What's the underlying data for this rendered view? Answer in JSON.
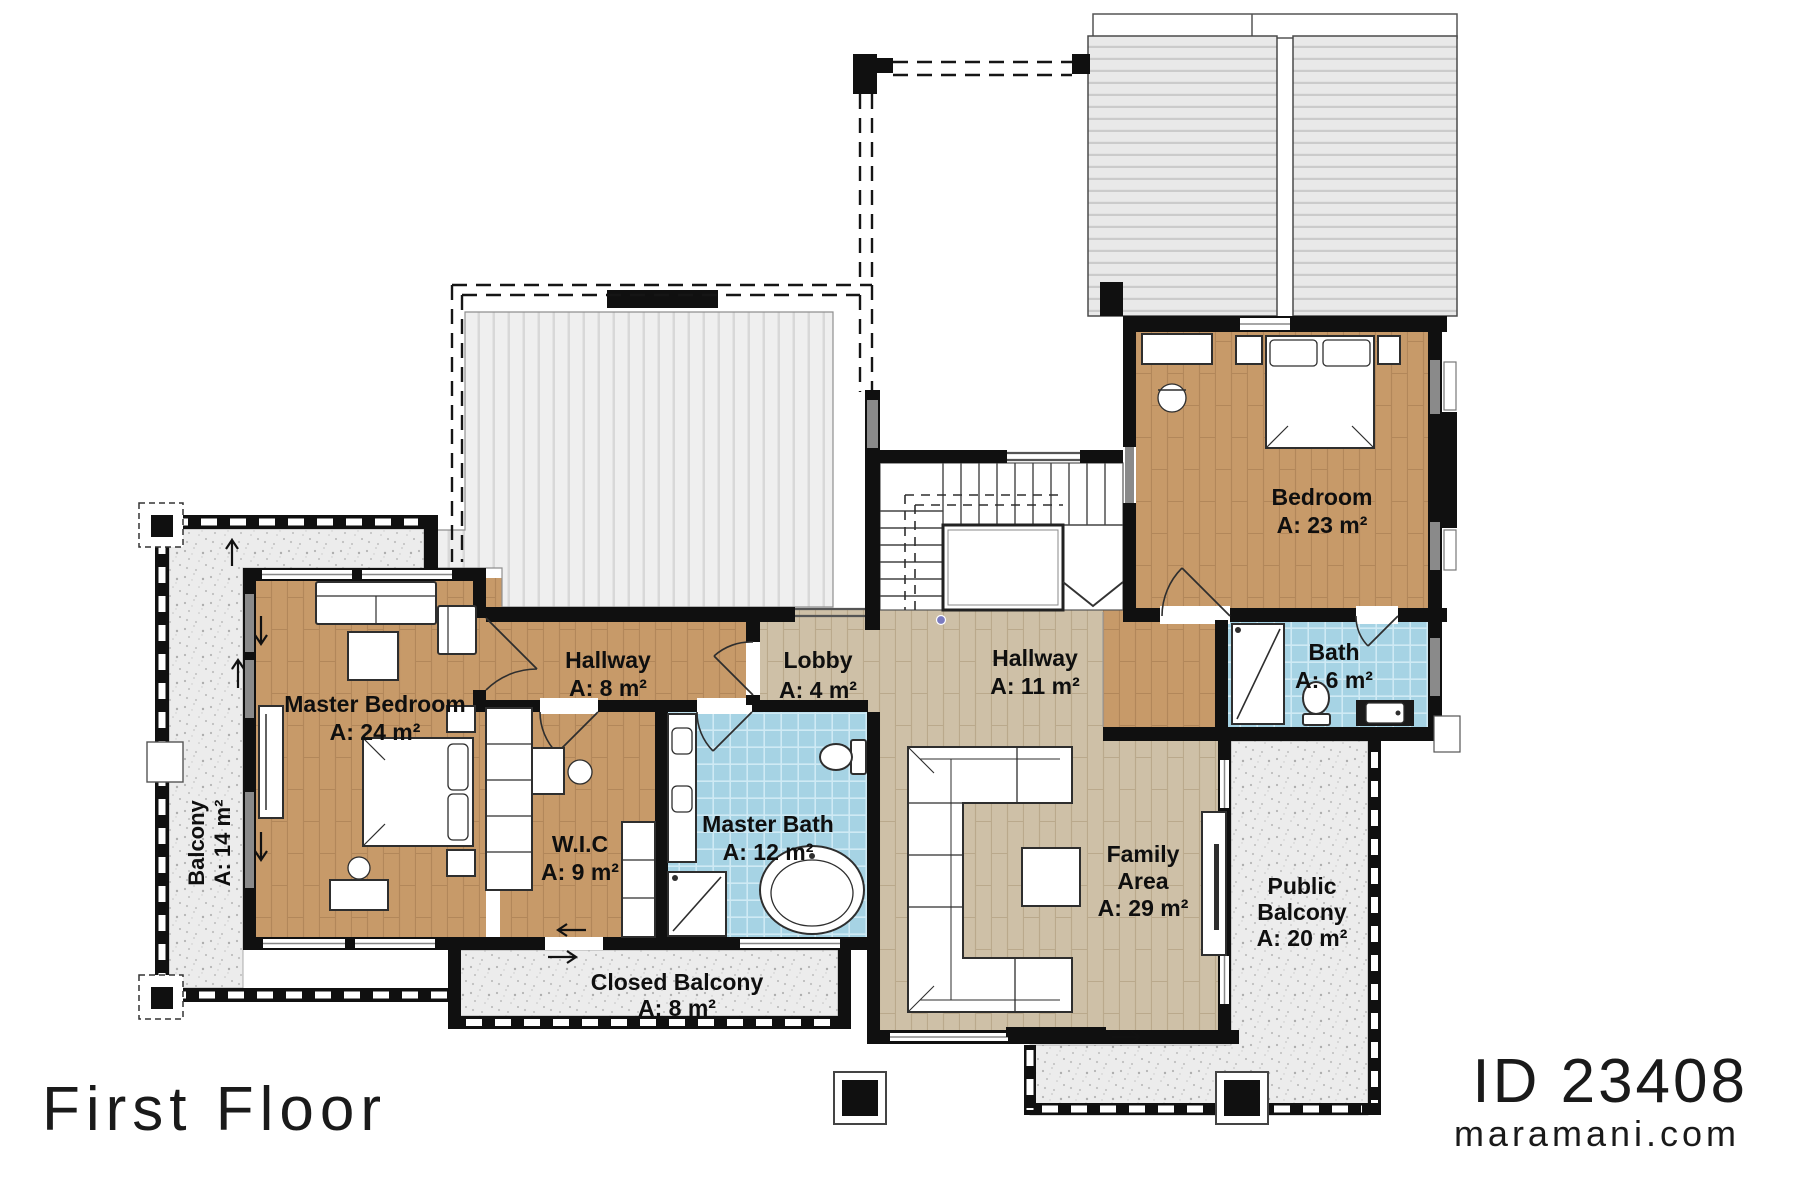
{
  "page": {
    "title": "First Floor"
  },
  "branding": {
    "plan_id": "ID 23408",
    "website": "maramani.com"
  },
  "rooms": {
    "master_bedroom": {
      "name": "Master Bedroom",
      "area": "A: 24 m²"
    },
    "hallway_west": {
      "name": "Hallway",
      "area": "A: 8 m²"
    },
    "lobby": {
      "name": "Lobby",
      "area": "A: 4 m²"
    },
    "hallway_main": {
      "name": "Hallway",
      "area": "A: 11 m²"
    },
    "bedroom": {
      "name": "Bedroom",
      "area": "A: 23 m²"
    },
    "bath": {
      "name": "Bath",
      "area": "A: 6 m²"
    },
    "master_bath": {
      "name": "Master Bath",
      "area": "A: 12 m²"
    },
    "wic": {
      "name": "W.I.C",
      "area": "A: 9 m²"
    },
    "family_area": {
      "name_line1": "Family",
      "name_line2": "Area",
      "area": "A: 29 m²"
    },
    "public_balcony": {
      "name_line1": "Public",
      "name_line2": "Balcony",
      "area": "A: 20 m²"
    },
    "closed_balcony": {
      "name": "Closed Balcony",
      "area": "A: 8 m²"
    },
    "balcony_west": {
      "name": "Balcony",
      "area": "A: 14 m²"
    }
  },
  "colors": {
    "wall": "#101010",
    "wood_dark": "#c79a69",
    "wood_light": "#cec0a7",
    "tile_blue": "#a6d3e4",
    "balcony_gray": "#ececec",
    "roof_gray": "#e9e9e9"
  }
}
